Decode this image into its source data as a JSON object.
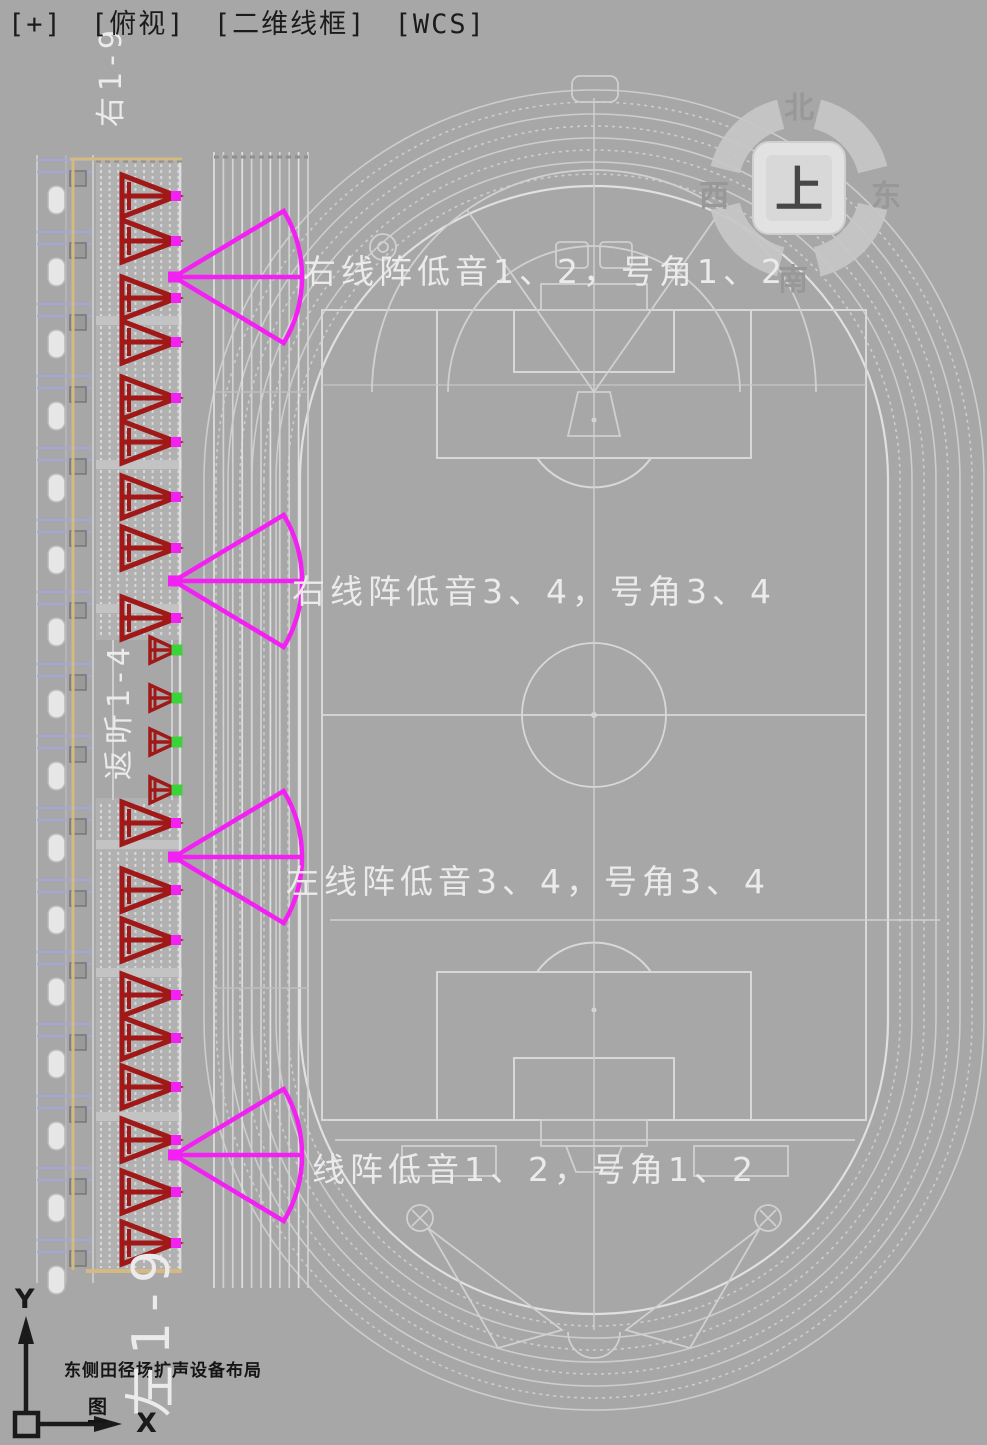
{
  "viewport_controls": {
    "expand": "[+]",
    "view": "[俯视]",
    "style": "[二维线框]",
    "cs": "[WCS]"
  },
  "viewcube": {
    "north": "北",
    "west": "西",
    "east": "东",
    "south": "南",
    "face": "上"
  },
  "fan_labels": [
    {
      "text": "右线阵低音1、2，号角1、2"
    },
    {
      "text": "右线阵低音3、4，号角3、4"
    },
    {
      "text": "左线阵低音3、4，号角3、4"
    },
    {
      "text": "线阵低音1、2，号角1、2"
    }
  ],
  "speaker_groups": [
    {
      "label": "右1-9",
      "count": 9,
      "type": "line-array"
    },
    {
      "label": "返听1-4",
      "count": 4,
      "type": "monitor"
    },
    {
      "label": "左1-9",
      "count": 9,
      "type": "line-array"
    }
  ],
  "caption": {
    "title": "东侧田径场扩声设备布局",
    "figure": "图"
  },
  "ucs": {
    "x": "X",
    "y": "Y"
  },
  "colors": {
    "background": "#a7a7a7",
    "wireframe": "#cdcdcd",
    "wireframe_bright": "#e0e0e0",
    "speaker_red": "#a01818",
    "coverage_magenta": "#f320f3",
    "monitor_green": "#3ad43a",
    "structure_tan": "#d4ba82",
    "structure_blue": "#a3a6db",
    "stand_fill": "#b1b1b1",
    "label_white": "#ebebeb",
    "text_black": "#1b1b1b"
  }
}
